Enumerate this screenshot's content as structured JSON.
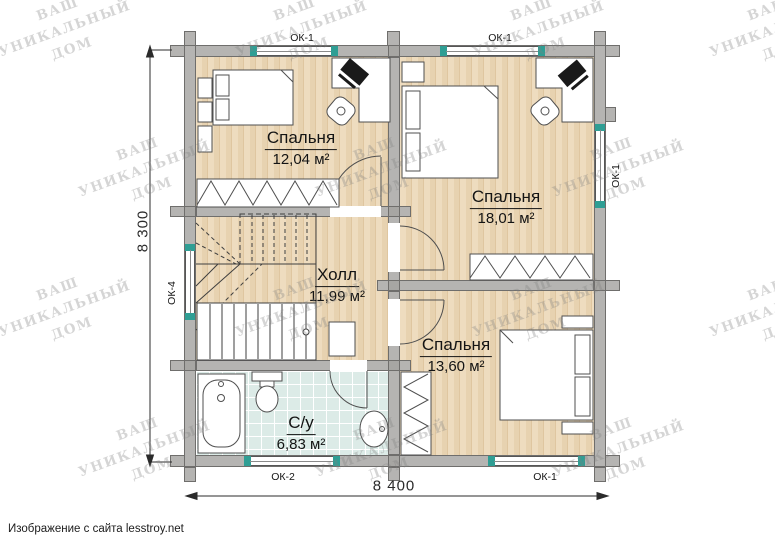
{
  "plan": {
    "rooms": [
      {
        "name": "Спальня",
        "area": "12,04 м²"
      },
      {
        "name": "Спальня",
        "area": "18,01 м²"
      },
      {
        "name": "Холл",
        "area": "11,99 м²"
      },
      {
        "name": "Спальня",
        "area": "13,60 м²"
      },
      {
        "name": "С/у",
        "area": "6,83 м²"
      }
    ],
    "windows": {
      "top_left": "ОК-1",
      "top_right": "ОК-1",
      "right": "ОК-1",
      "left": "ОК-4",
      "bottom_left": "ОК-2",
      "bottom_right": "ОК-1"
    },
    "dimensions": {
      "vertical": "8 300",
      "horizontal": "8 400"
    }
  },
  "watermark": {
    "line1": "ВАШ УНИКАЛЬНЫЙ",
    "line2": "ДОМ"
  },
  "caption": "Изображение с сайта lesstroy.net",
  "colors": {
    "wall": "#b5b4b2",
    "tile": "#dcebe7",
    "accent_teal": "#2f9e94"
  }
}
